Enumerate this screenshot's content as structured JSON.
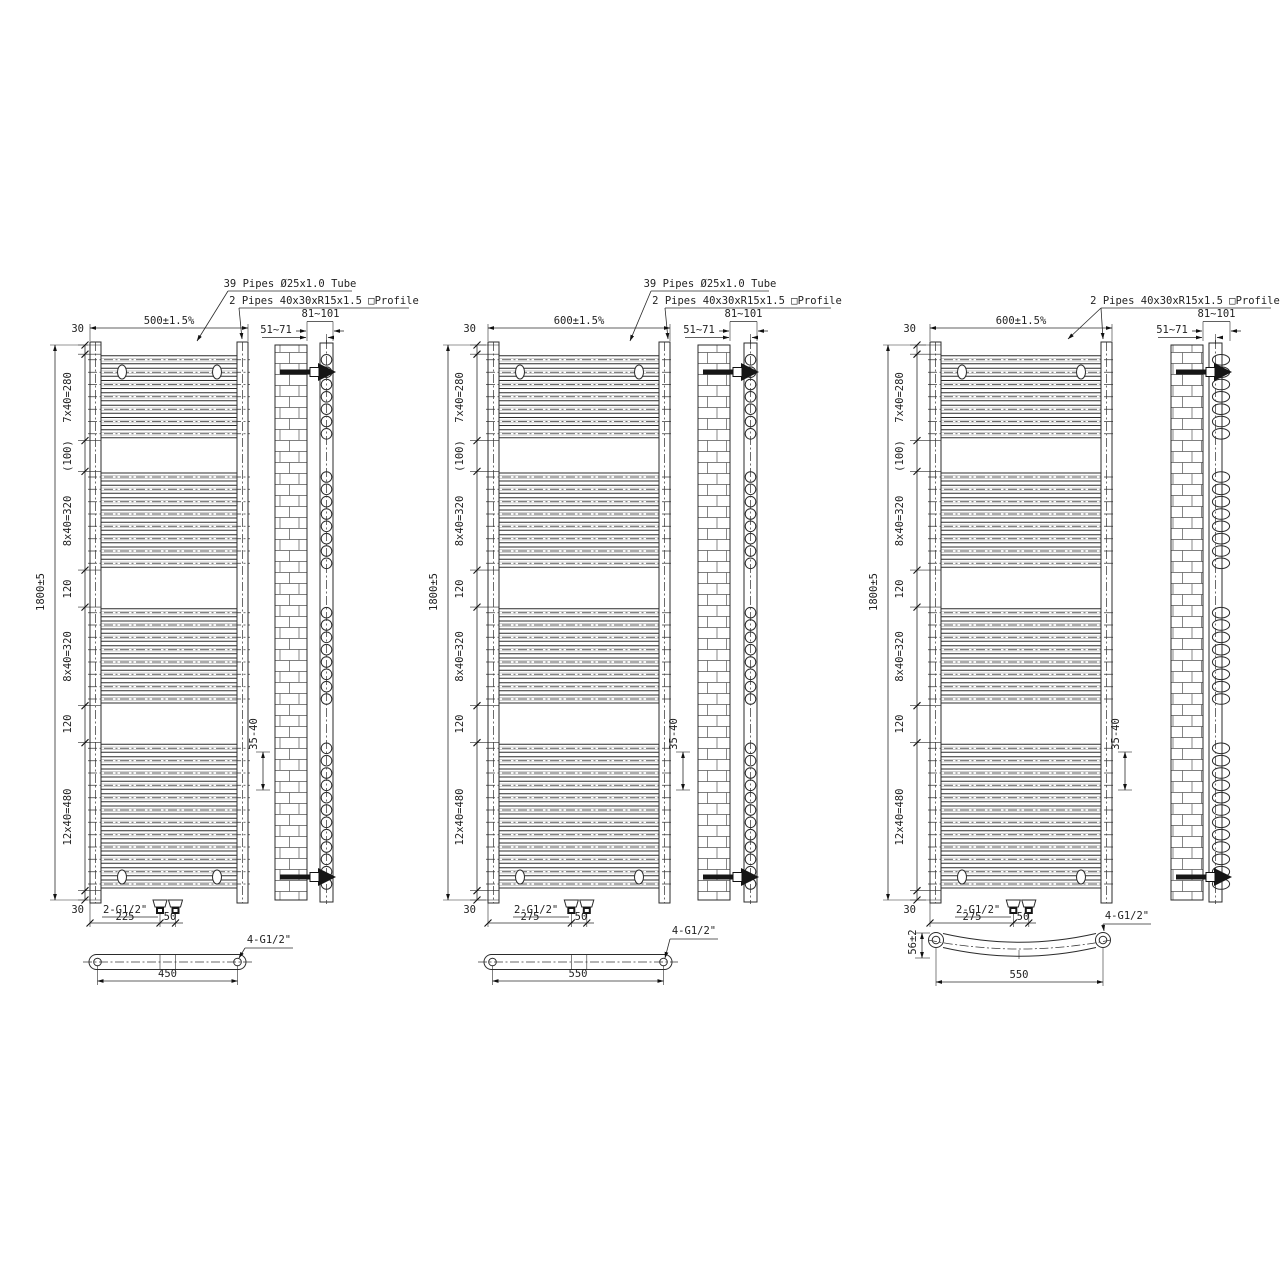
{
  "drawings": [
    {
      "pipes_note": "39 Pipes Ø25x1.0 Tube",
      "profile_note": "2 Pipes 40x30xR15x1.5 □Profile",
      "overall_width": "500±1.5%",
      "overall_height": "1800±5",
      "top_margin": "30",
      "bottom_margin": "30",
      "pipe_groups": [
        7,
        8,
        8,
        12
      ],
      "chain_dims": [
        "7x40=280",
        "(100)",
        "8x40=320",
        "120",
        "8x40=320",
        "120",
        "12x40=480"
      ],
      "bracket_wall_min": "51~71",
      "bracket_wall_max": "81~101",
      "wall_clearance": "35-40",
      "inlet_label": "2-G1/2\"",
      "inlet_offset": "225",
      "inlet_spacing": "50",
      "connection_label": "4-G1/2\"",
      "connection_span": "450"
    },
    {
      "pipes_note": "39 Pipes Ø25x1.0 Tube",
      "profile_note": "2 Pipes 40x30xR15x1.5 □Profile",
      "overall_width": "600±1.5%",
      "overall_height": "1800±5",
      "top_margin": "30",
      "bottom_margin": "30",
      "pipe_groups": [
        7,
        8,
        8,
        12
      ],
      "chain_dims": [
        "7x40=280",
        "(100)",
        "8x40=320",
        "120",
        "8x40=320",
        "120",
        "12x40=480"
      ],
      "bracket_wall_min": "51~71",
      "bracket_wall_max": "81~101",
      "wall_clearance": "35-40",
      "inlet_label": "2-G1/2\"",
      "inlet_offset": "275",
      "inlet_spacing": "50",
      "connection_label": "4-G1/2\"",
      "connection_span": "550"
    },
    {
      "profile_note": "2 Pipes 40x30xR15x1.5 □Profile",
      "overall_width": "600±1.5%",
      "overall_height": "1800±5",
      "top_margin": "30",
      "bottom_margin": "30",
      "pipe_groups": [
        7,
        8,
        8,
        12
      ],
      "chain_dims": [
        "7x40=280",
        "(100)",
        "8x40=320",
        "120",
        "8x40=320",
        "120",
        "12x40=480"
      ],
      "bracket_wall_min": "51~71",
      "bracket_wall_max": "81~101",
      "wall_clearance": "35-40",
      "inlet_label": "2-G1/2\"",
      "inlet_offset": "275",
      "inlet_spacing": "50",
      "connection_label": "4-G1/2\"",
      "connection_span": "550",
      "bow_depth": "56±2"
    }
  ]
}
